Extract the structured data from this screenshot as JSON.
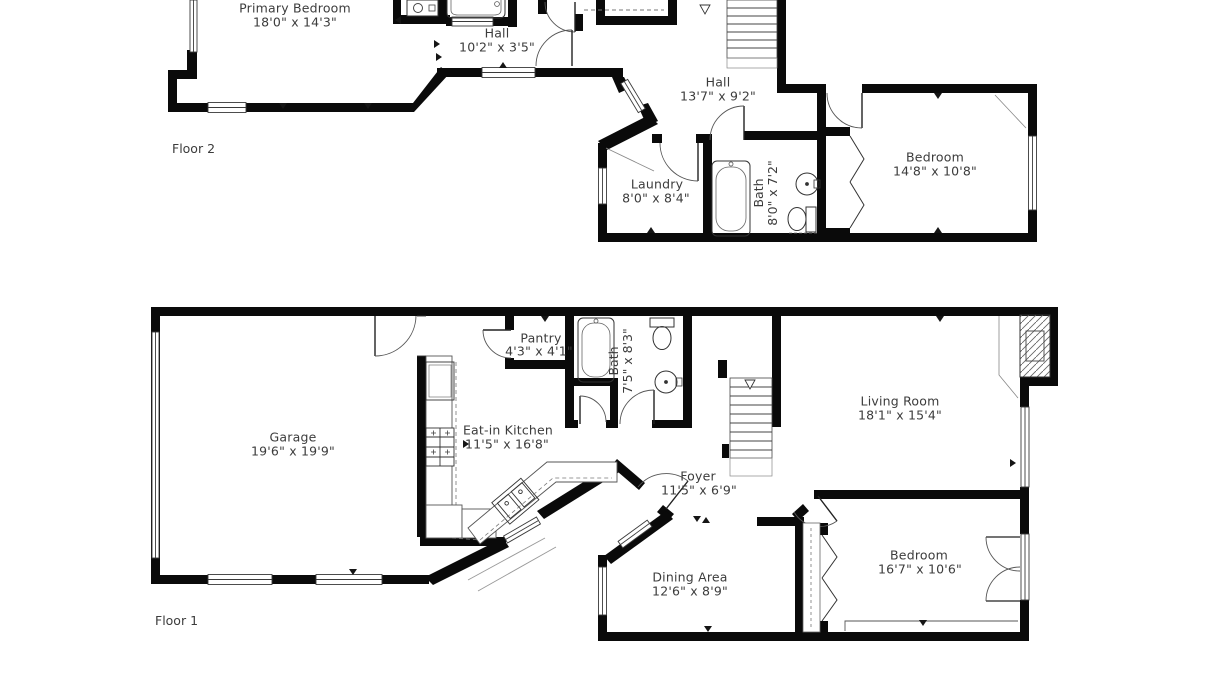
{
  "document": {
    "type": "residential floor plan, two stacked floor diagrams"
  },
  "floor2": {
    "label": "Floor 2",
    "rooms": {
      "primary_bedroom": {
        "name": "Primary Bedroom",
        "dims": "18'0\" x 14'3\""
      },
      "hall_upper": {
        "name": "Hall",
        "dims": "10'2\" x 3'5\""
      },
      "hall": {
        "name": "Hall",
        "dims": "13'7\" x 9'2\""
      },
      "laundry": {
        "name": "Laundry",
        "dims": "8'0\" x 8'4\""
      },
      "bath": {
        "name": "Bath",
        "dims": "8'0\" x 7'2\""
      },
      "bedroom": {
        "name": "Bedroom",
        "dims": "14'8\" x 10'8\""
      }
    }
  },
  "floor1": {
    "label": "Floor 1",
    "rooms": {
      "garage": {
        "name": "Garage",
        "dims": "19'6\" x 19'9\""
      },
      "pantry": {
        "name": "Pantry",
        "dims": "4'3\" x 4'1\""
      },
      "eat_in_kitchen": {
        "name": "Eat-in Kitchen",
        "dims": "11'5\" x 16'8\""
      },
      "bath": {
        "name": "Bath",
        "dims": "7'5\" x 8'3\""
      },
      "living_room": {
        "name": "Living Room",
        "dims": "18'1\" x 15'4\""
      },
      "foyer": {
        "name": "Foyer",
        "dims": "11'5\" x 6'9\""
      },
      "dining_area": {
        "name": "Dining Area",
        "dims": "12'6\" x 8'9\""
      },
      "bedroom": {
        "name": "Bedroom",
        "dims": "16'7\" x 10'6\""
      }
    }
  },
  "colors": {
    "wall": "#0a0a0a",
    "text": "#3c3c3c",
    "background": "#ffffff",
    "thin_line": "#555555"
  }
}
